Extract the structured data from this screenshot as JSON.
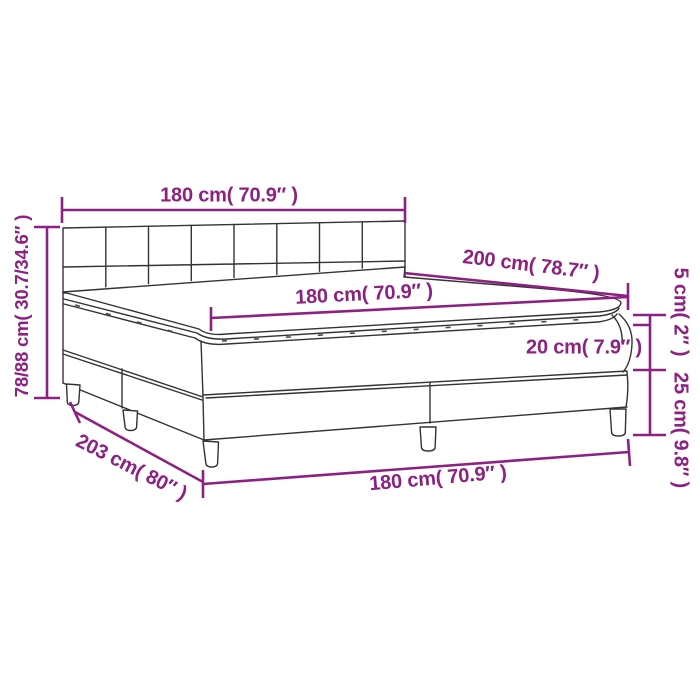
{
  "diagram": {
    "type": "product-dimension-diagram",
    "subject": "box-spring-bed",
    "accent_color": "#8C2182",
    "outline_color": "#333333",
    "background_color": "#FFFFFF",
    "measurements": {
      "headboard_width": "180 cm( 70.9″ )",
      "bed_length_top": "200 cm( 78.7″ )",
      "mattress_width": "180 cm( 70.9″ )",
      "topper_height": "5 cm( 2″ )",
      "mattress_height": "20 cm( 7.9″ )",
      "base_height": "25 cm( 9.8″ )",
      "headboard_height": "78/88 cm( 30.7/34.6″ )",
      "base_length": "203 cm( 80″ )",
      "base_width_bottom": "180 cm( 70.9″ )"
    }
  }
}
